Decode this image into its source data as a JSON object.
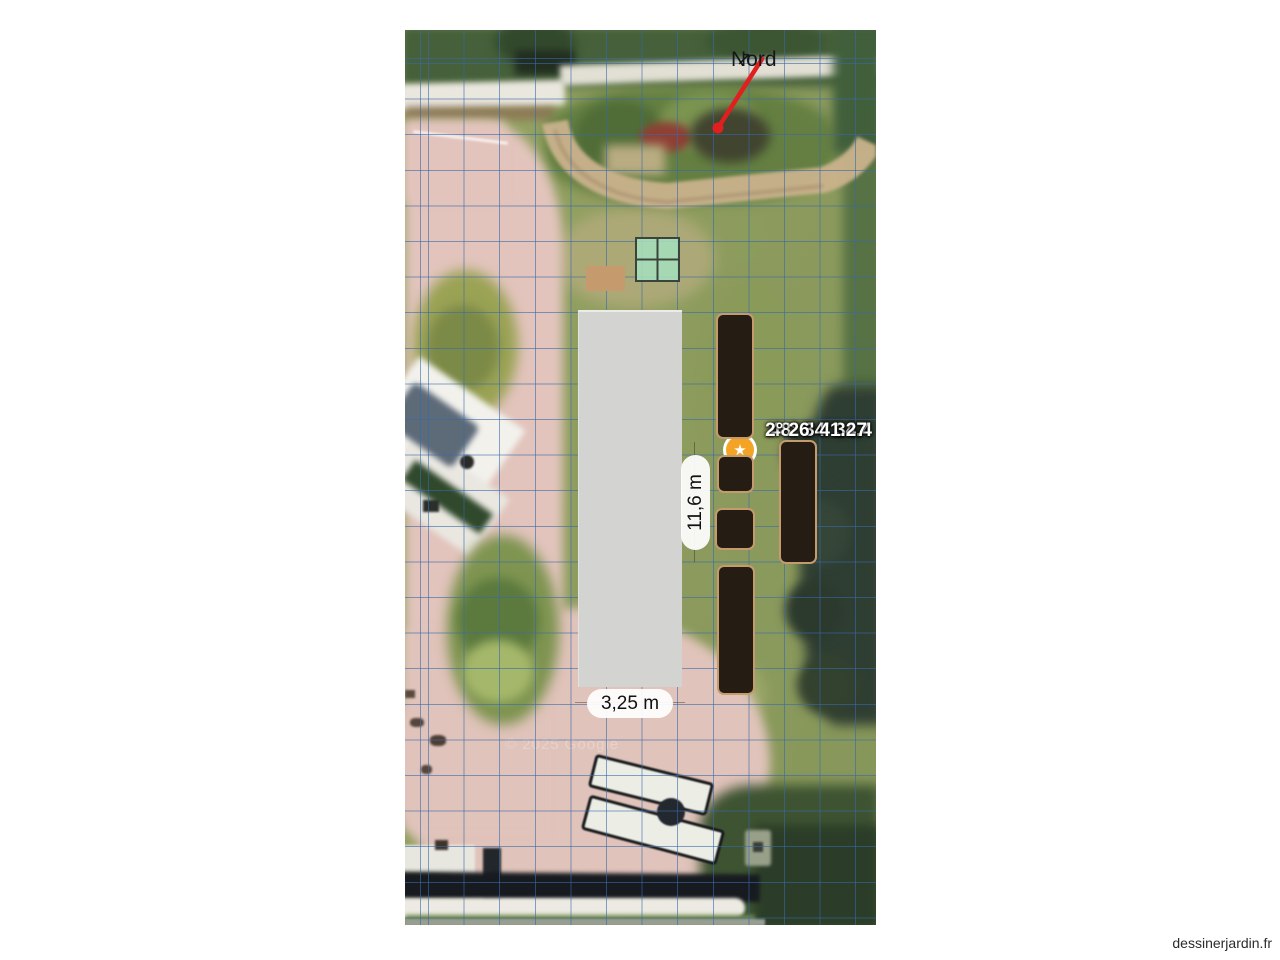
{
  "page": {
    "watermark": "dessinerjardin.fr"
  },
  "map": {
    "north": {
      "label": "Nord",
      "arrow_glyph": "↗"
    },
    "coordinates": {
      "latitude": "48° 34' 34.4",
      "longitude": "2° 26' 41.27"
    },
    "credit": "© 2025 Google",
    "shed": {
      "width_label": "3,25 m",
      "height_label": "11,6 m"
    },
    "marker": {
      "glyph": "★"
    },
    "beds": [
      {
        "x": 311,
        "y": 283,
        "w": 38,
        "h": 126
      },
      {
        "x": 312,
        "y": 425,
        "w": 37,
        "h": 38
      },
      {
        "x": 310,
        "y": 478,
        "w": 40,
        "h": 42
      },
      {
        "x": 312,
        "y": 535,
        "w": 38,
        "h": 130
      },
      {
        "x": 374,
        "y": 410,
        "w": 38,
        "h": 124
      }
    ],
    "planter_pair_cells": 2,
    "colors": {
      "grid-color": "rgba(55,105,170,0.6)",
      "bed-fill": "#251c13",
      "bed-border": "#c59b6e",
      "marker-color": "#f4a425",
      "north-arrow": "#e01f1f",
      "shed-fill": "#d3d3d2",
      "planter-fill": "rgba(165,225,190,0.85)",
      "planter-border": "#3a443b"
    }
  }
}
